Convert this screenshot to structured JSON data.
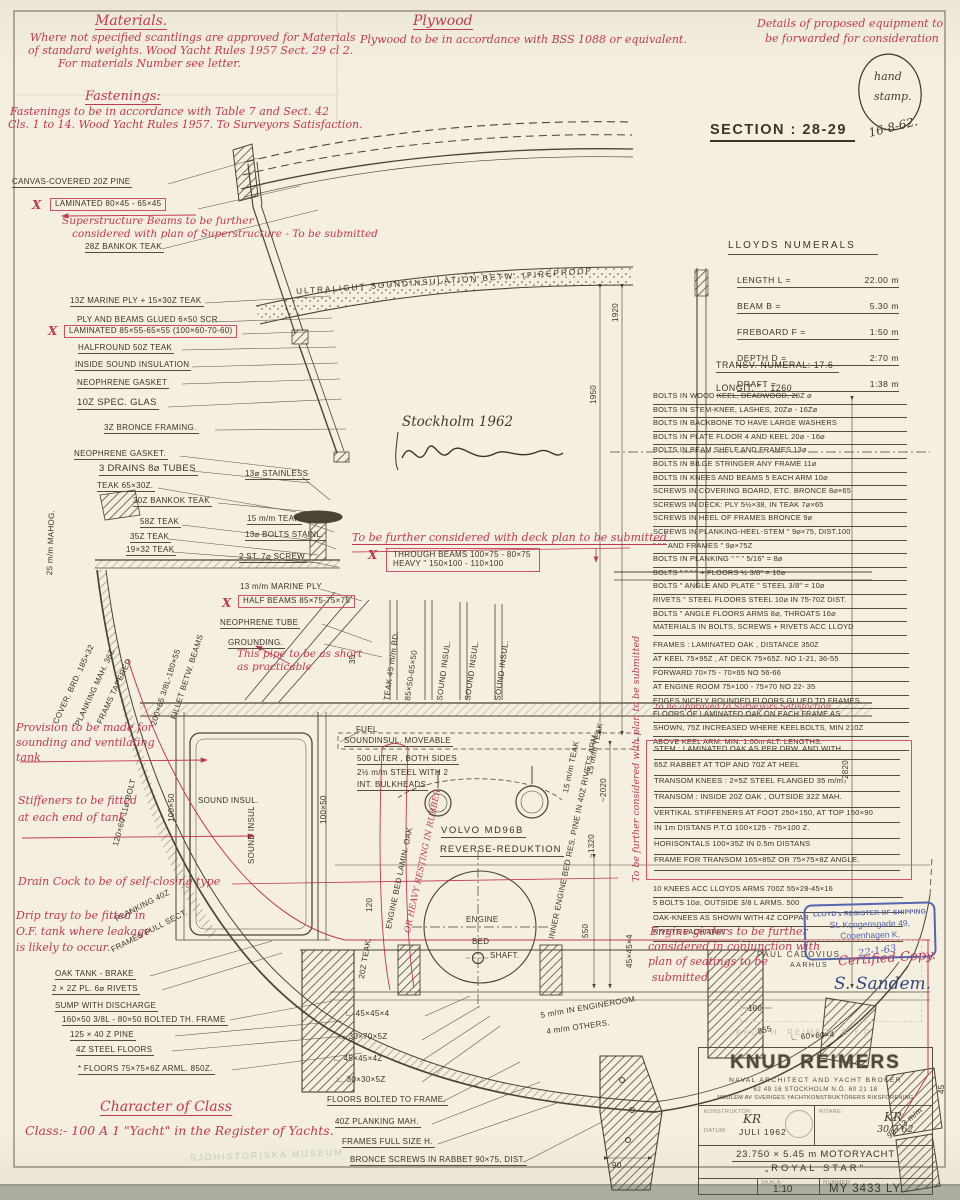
{
  "colors": {
    "paper": "#f4efde",
    "black_ink": "#3a342b",
    "red_ink": "#c23850",
    "blue_stamp": "#5565ae"
  },
  "header": {
    "materials_title": "Materials.",
    "materials_l1": "Where not specified scantlings are approved for Materials",
    "materials_l2": "of standard weights. Wood Yacht Rules 1957 Sect. 29 cl 2.",
    "materials_l3": "For materials Number see letter.",
    "fastenings_title": "Fastenings:",
    "fastenings_l1": "Fastenings to be in accordance with Table 7 and Sect. 42",
    "fastenings_l2": "Cls. 1 to 14. Wood Yacht Rules 1957. To Surveyors Satisfaction.",
    "plywood_title": "Plywood",
    "plywood_body": "Plywood to be in accordance with BSS 1088 or equivalent.",
    "equipment_l1": "Details of proposed equipment to",
    "equipment_l2": "be forwarded for consideration",
    "stamp_l1": "hand",
    "stamp_l2": "stamp.",
    "stamp_date": "16-8-62.",
    "section_title": "SECTION : 28-29"
  },
  "lloyds": {
    "title": "LLOYDS NUMERALS",
    "rows": [
      {
        "l": "LENGTH L =",
        "v": "22.00 m"
      },
      {
        "l": "BEAM   B =",
        "v": "5.30 m"
      },
      {
        "l": "FREBOARD F =",
        "v": "1:50 m"
      },
      {
        "l": "DEPTH   D =",
        "v": "2:70 m"
      },
      {
        "l": "DRAFT      =",
        "v": "1:38 m"
      }
    ],
    "transv": "TRANSV.  NUMERAL:   17.6",
    "longit": "LONGIT.      \"      :    1260"
  },
  "specs": {
    "bolts": [
      "BOLTS  IN  WOOD KEEL, DEADWOOD,  20Z ⌀",
      "BOLTS  IN  STEM-KNEE, LASHES,  20Z⌀ - 16Z⌀",
      "BOLTS  IN  BACKBONE TO HAVE LARGE WASHERS",
      "BOLTS  IN  PLATE FLOOR 4 AND KEEL  20⌀ - 16⌀",
      "BOLTS  IN  BEAM SHELF AND FRAMES  13⌀",
      "BOLTS  IN  BILGE STRINGER ANY FRAME  11⌀",
      "BOLTS  IN  KNEES AND BEAMS  5 EACH ARM 10⌀",
      "SCREWS IN  COVERING BOARD, ETC. BRONCE 8⌀×65",
      "SCREWS IN  DECK: PLY 5½×38, IN TEAK 7⌀×65",
      "SCREWS IN  HEEL OF FRAMES  BRONCE  9⌀",
      "SCREWS IN  PLANKING-HEEL-STEM  \"  9⌀×75, DIST.100",
      "  \"        \"        \" AND FRAMES    \"    9⌀×75Z",
      "BOLTS  IN  PLANKING  \"      \"       \"  5/16\" = 8⌀",
      "BOLTS   \"      \"      \"     \" + FLOORS  ½ 3/8\" = 10⌀",
      "BOLTS   \"   ANGLE AND PLATE  \"   STEEL 3/8\" = 10⌀",
      "RIVETS  \"   STEEL FLOORS   STEEL 10⌀ IN 75-70Z DIST.",
      "BOLTS   \"   ANGLE FLOORS ARMS  8⌀, THROATS 16⌀",
      "MATERIALS IN BOLTS, SCREWS + RIVETS ACC LLOYD"
    ],
    "frames": [
      "FRAMES :  LAMINATED  OAK ,  DISTANCE  350Z",
      "AT KEEL   75×95Z ,  AT DECK   75×65Z.  NO 1-21, 36-55",
      "FORWARD   70×75  - 70×65   NO  56-66",
      "AT ENGINE ROOM 75×100 - 75×70   NO 22- 35",
      "EDGES  NICELY  ROUNDED  FLOORS   GLUED   TO FRAMES.",
      "FLOORS  OF LAMINATED OAK ON EACH FRAME AS",
      "SHOWN, 75Z  INCREASED WHERE KEELBOLTS, MIN 210Z",
      "ABOVE  KEEL   ARM. MIN. 1.00m  ALT. LENGTHS."
    ],
    "frames_red_note": "to be approved to Surveyors Satisfaction,",
    "stem": [
      "STEM :   LAMINATED  OAK  AS  PER  DRW. AND  WITH",
      "65Z RABBET  AT  TOP  AND  70Z  AT HEEL",
      "TRANSOM  KNEES :    2×5Z  STEEL  FLANGED  35 m/m",
      "TRANSOM :  INSIDE  20Z OAK ,  OUTSIDE 32Z  MAH.",
      "VERTIKAL STIFFENERS AT FOOT 250×150, AT TOP 150×90",
      "IN 1m DISTANS  P.T.O 100×125 - 75×100 Z.",
      "HORISONTALS  100×35Z  IN  0.5m  DISTANS",
      "FRAME  FOR  TRANSOM  165×85Z  OR  75×75×8Z  ANGLE."
    ],
    "knees": [
      "10 KNEES   ACC  LLOYDS   ARMS  700Z  55×28-45×16",
      "5 BOLTS   10⌀,   OUTSIDE  3/8 L   ARMS.  500",
      "OAK-KNEES   AS   SHOWN    WITH   4Z  COPPAR",
      "RIVETS    EACH   ARM."
    ]
  },
  "girders_note": [
    "Engine girders to be further",
    "considered in conjunction with",
    "plan of seatings to be",
    "submitted"
  ],
  "stamps": {
    "lloyds_l1": "LLOYD's REGISTER OF SHIPPING",
    "lloyds_l2": "St. Kongensgade 49,",
    "lloyds_l3": "Copenhagen K.",
    "lloyds_date": "22-1-63",
    "cadovius_l1": "PAUL CADOVIUS",
    "cadovius_l2": "AARHUS",
    "certified": "Certified Copy.",
    "signature": "S. Sandem.",
    "faint_stamp": "KNUD H. REIMERS   S.Y.R.",
    "faint_museum": "SJÖHISTORISKA MUSEUM",
    "site_sig": "Stockholm 1962"
  },
  "title_block": {
    "name": "KNUD REIMERS",
    "subtitle": "NAVAL ARCHITECT AND YACHT BROKER",
    "phones": "62 49 16        STOCKHOLM N.Ö.        60 21 18",
    "member": "MEDLEM AV SVERIGES YACHTKONSTRUKTÖRERS RIKSFÖRENING",
    "konstruktor_label": "KONSTRUKTÖR:",
    "konstruktor_value": "KR",
    "ritare_label": "RITARE:",
    "ritare_value": "KR",
    "ritare_date": "30/7 62",
    "datum_label": "DATUM:",
    "datum_value": "JULI  1962",
    "boat": "23.750 × 5.45 m   MOTORYACHT",
    "boat_name": "„ROYAL  STAR\"",
    "skala_label": "SKALA:",
    "skala_value": "1:10",
    "nummer_label": "NUMMER:",
    "nummer_value": "MY 3433 LY."
  },
  "labels": {
    "canvas": "CANVAS-COVERED 20Z PINE",
    "lam_top": "LAMINATED  80×45 - 65×45",
    "bankok28": "28Z BANKOK  TEAK",
    "marine13": "13Z MARINE PLY + 15×30Z TEAK",
    "ply_glued": "PLY AND  BEAMS  GLUED  6×50 SCR",
    "lam_mid": "LAMINATED 85×55-65×55 (100×60-70-60)",
    "halfround": "HALFROUND  50Z TEAK",
    "inside_sound": "INSIDE  SOUND INSULATION",
    "gasket1": "NEOPHRENE  GASKET",
    "spec_glas": "10Z  SPEC.  GLAS",
    "bronce_framing": "3Z BRONCE  FRAMING.",
    "gasket2": "NEOPHRENE  GASKET.",
    "drains": "3 DRAINS  8⌀ TUBES",
    "teak6530": "TEAK  65×30Z.",
    "bankok30": "30Z BANKOK TEAK",
    "teak58": "58Z TEAK",
    "teak35": "35Z TEAK",
    "teak1932": "19×32 TEAK",
    "stainless13": "13⌀ STAINLESS",
    "teak15": "15 m/m TEAK",
    "bolts13": "13⌀  BOLTS  STAINL.",
    "screw7": "2 ST. 7⌀  SCREW",
    "through1": "THROUGH  BEAMS    100×75 - 80×75",
    "through2": "HEAVY          \"            150×100 - 110×100",
    "marine13b": "13 m/m MARINE PLY",
    "halfbeams": "HALF BEAMS  85×75-75×75",
    "neo_tube": "NEOPHRENE  TUBE",
    "grounding": "GROUNDING.",
    "ultralight": "ULTRALIGHT    SOUNDINSULATION   BETW.  (FIREPROOF",
    "fuel": "FUEL",
    "sound_move": "SOUNDINSUL.  MOVEABLE",
    "liter1": "500 LITER ,  BOTH SIDES",
    "liter2": "2½ m/m STEEL  WITH  2",
    "liter3": "INT. BULKHEADS",
    "volvo": "VOLVO   MD96B",
    "reverse": "REVERSE-REDUKTION",
    "engine": "ENGINE",
    "bed": "BED",
    "shaft": "SHAFT.",
    "oak_tank": "OAK  TANK - BRAKE",
    "pl22": "2 × 2Z  PL.  6⌀  RIVETS",
    "sump": "SUMP  WITH   DISCHARGE",
    "bolted160": "160×50 3/8L - 80×50   BOLTED TH. FRAME",
    "pine125": "125 × 40 Z   PINE",
    "steel4": "4Z STEEL  FLOORS",
    "floors75": "* FLOORS   75×75×6Z   ARML.   850Z.",
    "ang1": "∟ 45×45×4",
    "ang2": "∟ 30×70×5Z",
    "ang3": "∟ 45×45×4Z",
    "ang4": "∟ 30×30×5Z",
    "floors_bolted": "FLOORS  BOLTED  TO FRAME.",
    "planking40z": "40Z  PLANKING  MAH.",
    "frames_full_h": "FRAMES   FULL  SIZE  H.",
    "bronce_screws": "BRONCE  SCREWS  IN RABBET  90×75, DIST.",
    "mm5": "5 m/m IN ENGINEROOM",
    "mm4": "4 m/m OTHERS.",
    "ang60": "∟ 60×60×4",
    "planking40": "PLANKING  40Z",
    "frames_full": "FRAMES  FULL SECT.",
    "cover_brd": "COVER. BRD. 185×32",
    "planking_mah": "PLANKING MAH. 36Z",
    "frams_tapered": "FRAMS TAPERED",
    "l200": "200×65 3/8L-180×55",
    "fillet": "FILLET BETW. BEAMS",
    "mahog25": "25 m/m MAHOG.",
    "bolt120": "120×60  11⌀ BOLT",
    "sound_rot1": "SOUND INSUL.",
    "sound_rot2": "SOUND INSUL.",
    "sound_rot3": "SOUND INSUL.",
    "teak45": "TEAK 45 m/m BD.",
    "t8550": "85×50-65×50",
    "sound_tank": "SOUND  INSUL.",
    "sound_tank2": "SOUND INSUL",
    "h50a": "100×50",
    "h50b": "100×50",
    "engine_bed": "ENGINE BED LAMIN. OAK",
    "inner_bed": "INNER ENGINE BED RES. PINE IN 40Z RIVETS ARM.",
    "teak15a": "15 m/m TEAK",
    "teak15b": "15 m/m TEAK",
    "teak20": "20Z TEAK.",
    "d1920": "1920",
    "d1950": "1950",
    "d2820": "~2820",
    "d2020": "~2020",
    "d1320": "~1320",
    "d550": "550",
    "d45454": "45×45×4",
    "d120": "120",
    "d35": "35",
    "d45": "45",
    "d9013": "90×13 m/m",
    "d90": "90",
    "d100": "100",
    "d855": "855"
  },
  "red": {
    "sup1": "Superstructure Beams to be further",
    "sup2": "considered with plan of Superstructure - To be submitted",
    "deck_plan": "To be further considered with deck plan to be submitted",
    "pipe1": "This pipe to be as short",
    "pipe2": "as practicable",
    "prov1": "Provision to be made for",
    "prov2": "sounding and ventilating",
    "prov3": "tank",
    "stiff1": "Stiffeners to be fitted",
    "stiff2": "at each end of tank",
    "drain": "Drain Cock to be of self-closing type",
    "drip1": "Drip tray to be fitted in",
    "drip2": "O.F. tank where leakage",
    "drip3": "is likely to occur.",
    "class_title": "Character of Class",
    "class_line": "Class:-  100 A 1 \"Yacht\" in the Register of Yachts.",
    "heavy_rest": "OR HEAVY RESTING IN RUBBER",
    "side_note": "To be further considered with plan to be submitted",
    "x_mark": "X"
  }
}
